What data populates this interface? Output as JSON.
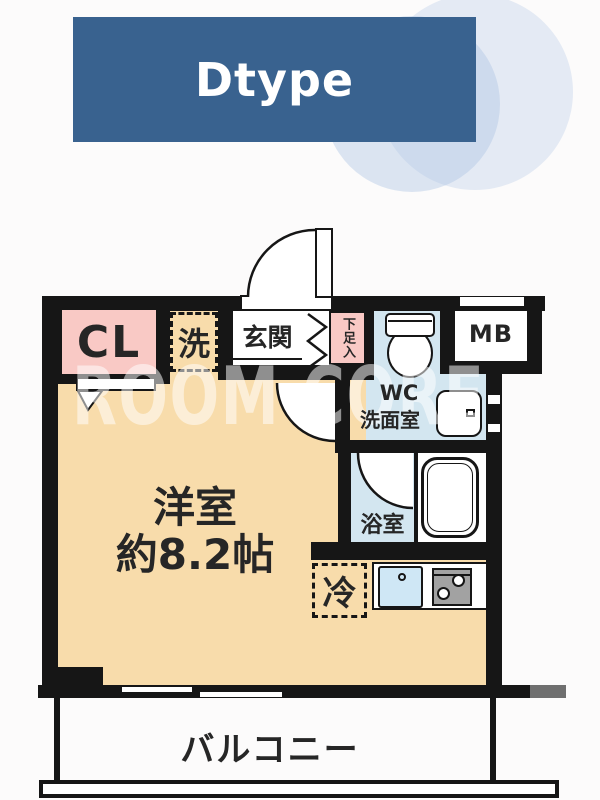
{
  "banner": {
    "label": "Dtype"
  },
  "watermark": {
    "text": "ROOM CORE"
  },
  "rooms": {
    "closet": "CL",
    "washer": "洗",
    "entrance": "玄関",
    "shoe_cabinet": "下足入",
    "meter_box": "MB",
    "toilet_line1": "WC",
    "toilet_line2": "洗面室",
    "bathroom": "浴室",
    "refrigerator": "冷",
    "main_room_name": "洋室",
    "main_room_size": "約8.2帖",
    "balcony": "バルコニー"
  },
  "colors": {
    "banner_blue": "#39628f",
    "floor_tan": "#f8dcab",
    "closet_pink": "#f9c9c5",
    "wet_area_blue": "#d3e6f0",
    "wall_black": "#161616",
    "decor_circle_blue": "#e3ebf5"
  }
}
